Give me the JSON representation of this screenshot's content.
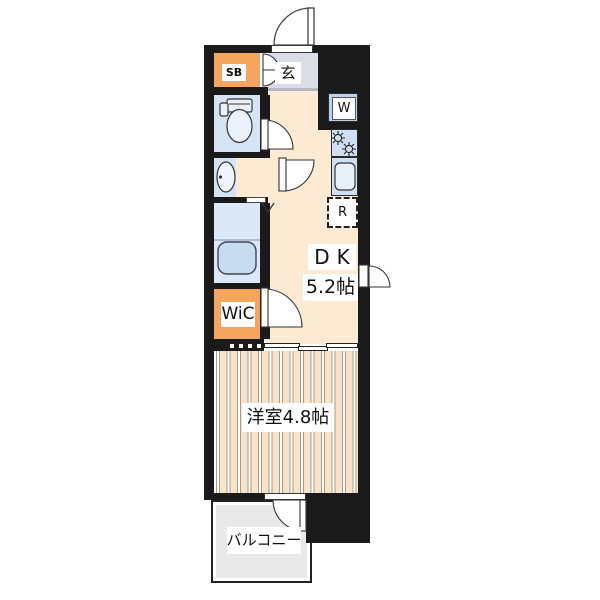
{
  "floorplan": {
    "type": "apartment-floor-plan",
    "labels": {
      "entrance": "玄",
      "shoe_box": "SB",
      "washing_machine": "W",
      "refrigerator": "R",
      "dining_kitchen_name": "DK",
      "dining_kitchen_size": "5.2帖",
      "walk_in_closet": "WiC",
      "western_room": "洋室4.8帖",
      "balcony": "バルコニー"
    },
    "rooms": [
      {
        "name": "entrance-hall",
        "label": "玄"
      },
      {
        "name": "shoe-box",
        "label": "SB"
      },
      {
        "name": "toilet",
        "label": ""
      },
      {
        "name": "washroom",
        "label": ""
      },
      {
        "name": "bathroom",
        "label": ""
      },
      {
        "name": "walk-in-closet",
        "label": "WiC"
      },
      {
        "name": "dining-kitchen",
        "label": "DK",
        "size": "5.2帖"
      },
      {
        "name": "western-room",
        "label": "洋室4.8帖"
      },
      {
        "name": "balcony",
        "label": "バルコニー"
      }
    ],
    "colors": {
      "wall": "#1a1a1a",
      "accent_orange": "#f5a55e",
      "wet_area_blue": "#d5e4f4",
      "fixture_blue": "#cfe0f4",
      "dk_floor": "#fcead3",
      "genkan_floor": "#dcdce6",
      "bedroom_floor": "#f8e3c8",
      "balcony_gray": "#e9e9e9"
    }
  }
}
